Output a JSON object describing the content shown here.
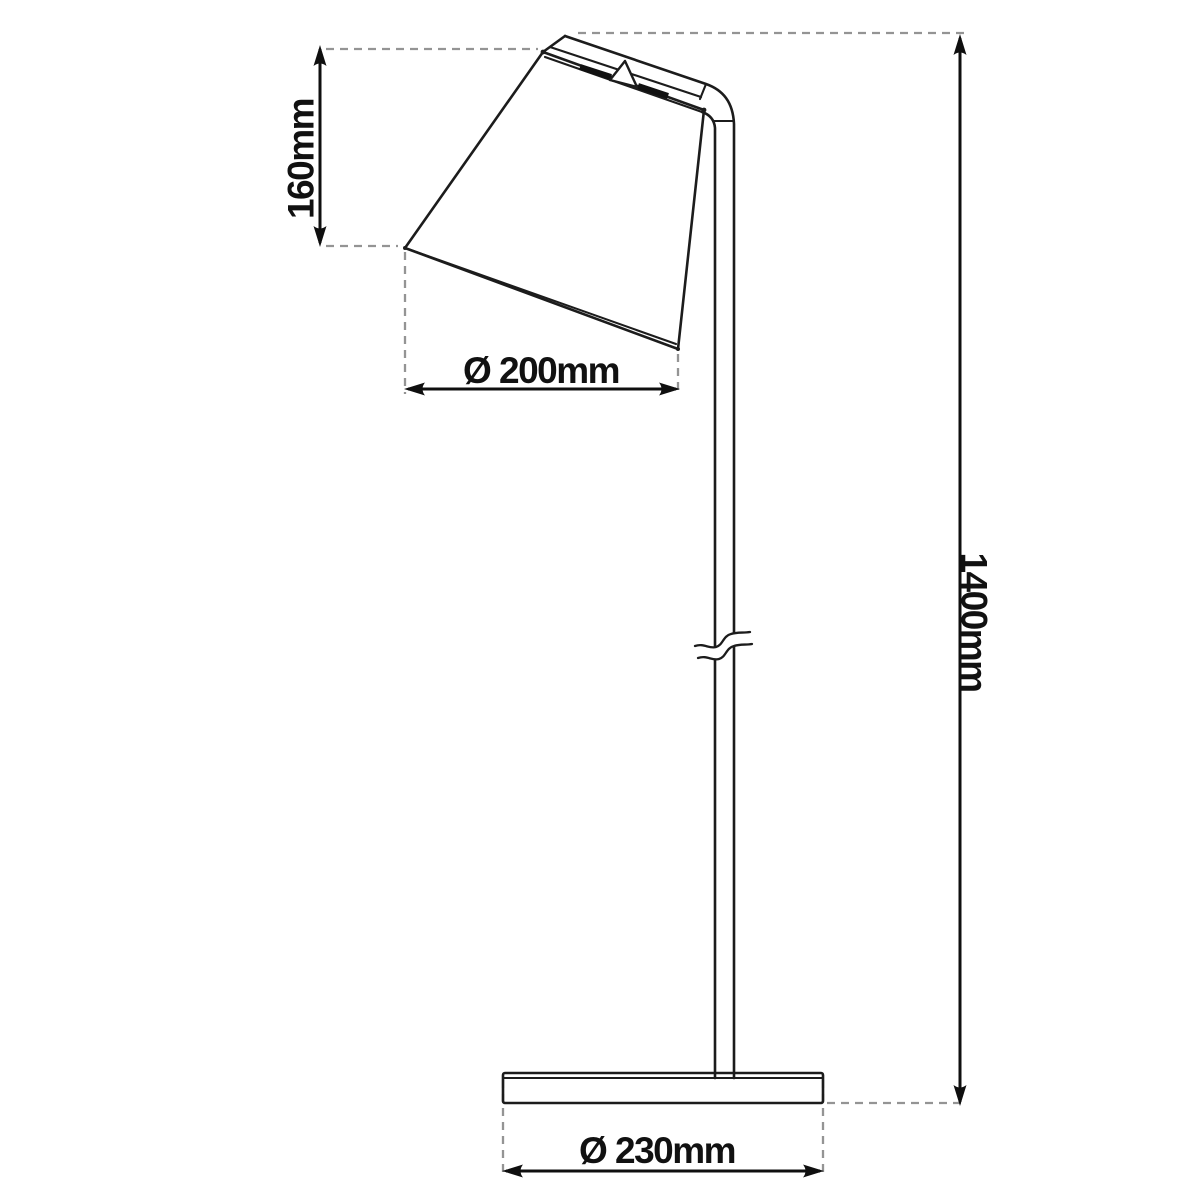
{
  "drawing": {
    "subject": "floor-lamp-technical-dimension-diagram",
    "dimensions": {
      "shade_height": "160mm",
      "shade_diameter": "Ø 200mm",
      "total_height": "1400mm",
      "base_diameter": "Ø 230mm"
    },
    "colors": {
      "outline": "#1c1c1c",
      "dimension": "#0f0f0f",
      "dashed_extension": "#949494",
      "background": "#ffffff"
    }
  }
}
